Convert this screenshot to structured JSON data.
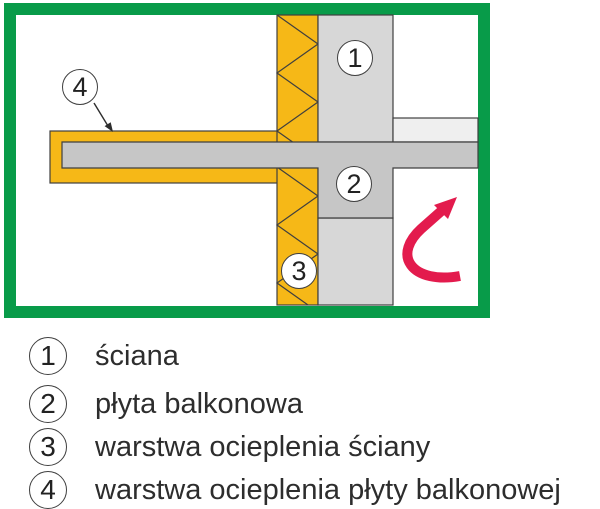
{
  "diagram": {
    "callouts": [
      {
        "number": "1"
      },
      {
        "number": "2"
      },
      {
        "number": "3"
      },
      {
        "number": "4"
      }
    ],
    "colors": {
      "frame-green": "#089b49",
      "insulation-yellow": "#f6b817",
      "wall-gray": "#d7d7d7",
      "slab-gray": "#c6c6c6",
      "floor-gray": "#efefef",
      "outline-dark": "#3f3f3f",
      "arrow-red": "#e31b4d",
      "text-dark": "#2d2d2d"
    }
  },
  "legend": {
    "items": [
      {
        "number": "1",
        "label": "ściana"
      },
      {
        "number": "2",
        "label": "płyta balkonowa"
      },
      {
        "number": "3",
        "label": "warstwa ocieplenia ściany"
      },
      {
        "number": "4",
        "label": "warstwa ocieplenia płyty balkonowej"
      }
    ]
  }
}
